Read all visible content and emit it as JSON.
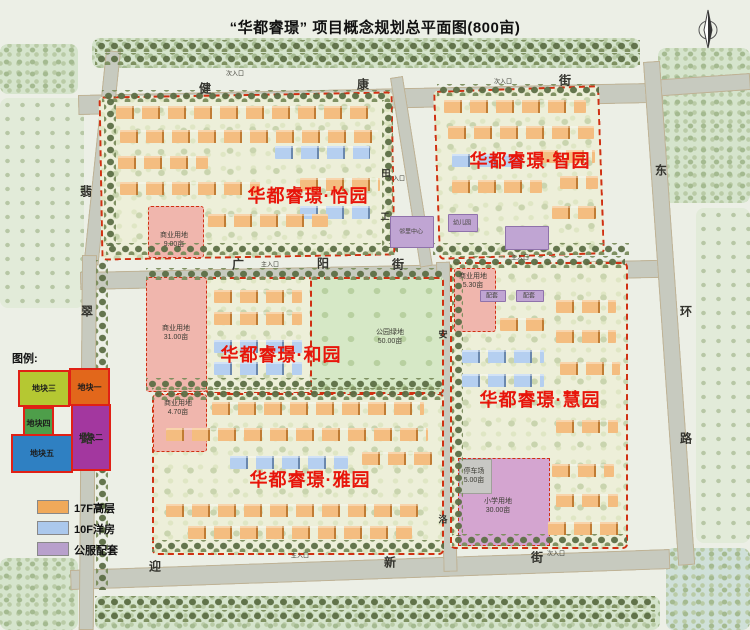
{
  "title": "“华都睿璟” 项目概念规划总平面图(800亩)",
  "districts": {
    "yiyuan": "华都睿璟·怡园",
    "zhiyuan": "华都睿璟·智园",
    "heyuan": "华都睿璟·和园",
    "yayuan": "华都睿璟·雅园",
    "huiyuan": "华都睿璟·慧园"
  },
  "streets": {
    "jiankang": [
      "健",
      "康",
      "街"
    ],
    "guangyang": [
      "广",
      "阳",
      "街"
    ],
    "yingxin": [
      "迎",
      "新",
      "街"
    ],
    "donghuan": [
      "东",
      "环",
      "路"
    ],
    "feicui": [
      "翡",
      "翠",
      "路"
    ],
    "tianjie": [
      "田",
      "工"
    ],
    "anluo": [
      "安",
      "洛"
    ]
  },
  "entrances": {
    "main": "主入口",
    "secondary": "次入口"
  },
  "parcels": {
    "commercial_nw": {
      "name": "商业用地",
      "area": "9.00亩"
    },
    "commercial_w": {
      "name": "商业用地",
      "area": "31.00亩"
    },
    "commercial_c": {
      "name": "商业用地",
      "area": "5.30亩"
    },
    "commercial_sw": {
      "name": "商业用地",
      "area": "4.70亩"
    },
    "park": {
      "name": "公园绿地",
      "area": "50.00亩"
    },
    "parking": {
      "name": "停车场",
      "area": "5.00亩"
    },
    "school": {
      "name": "小学用地",
      "area": "30.00亩"
    }
  },
  "facilities": {
    "kindergarten": "幼儿园",
    "neighborhood_center": "邻里中心",
    "support": "配套"
  },
  "legend": {
    "title": "图例:",
    "plots": [
      {
        "label": "地块一",
        "color": "#e2671b"
      },
      {
        "label": "地块二",
        "color": "#a3379f"
      },
      {
        "label": "地块三",
        "color": "#b5c832"
      },
      {
        "label": "地块四",
        "color": "#4e9e4a"
      },
      {
        "label": "地块五",
        "color": "#2f80c2"
      }
    ]
  },
  "building_legend": [
    {
      "label": "17F高层",
      "color": "#f0a95a"
    },
    {
      "label": "10F洋房",
      "color": "#abc8ec"
    },
    {
      "label": "公服配套",
      "color": "#b8a0cc"
    }
  ]
}
